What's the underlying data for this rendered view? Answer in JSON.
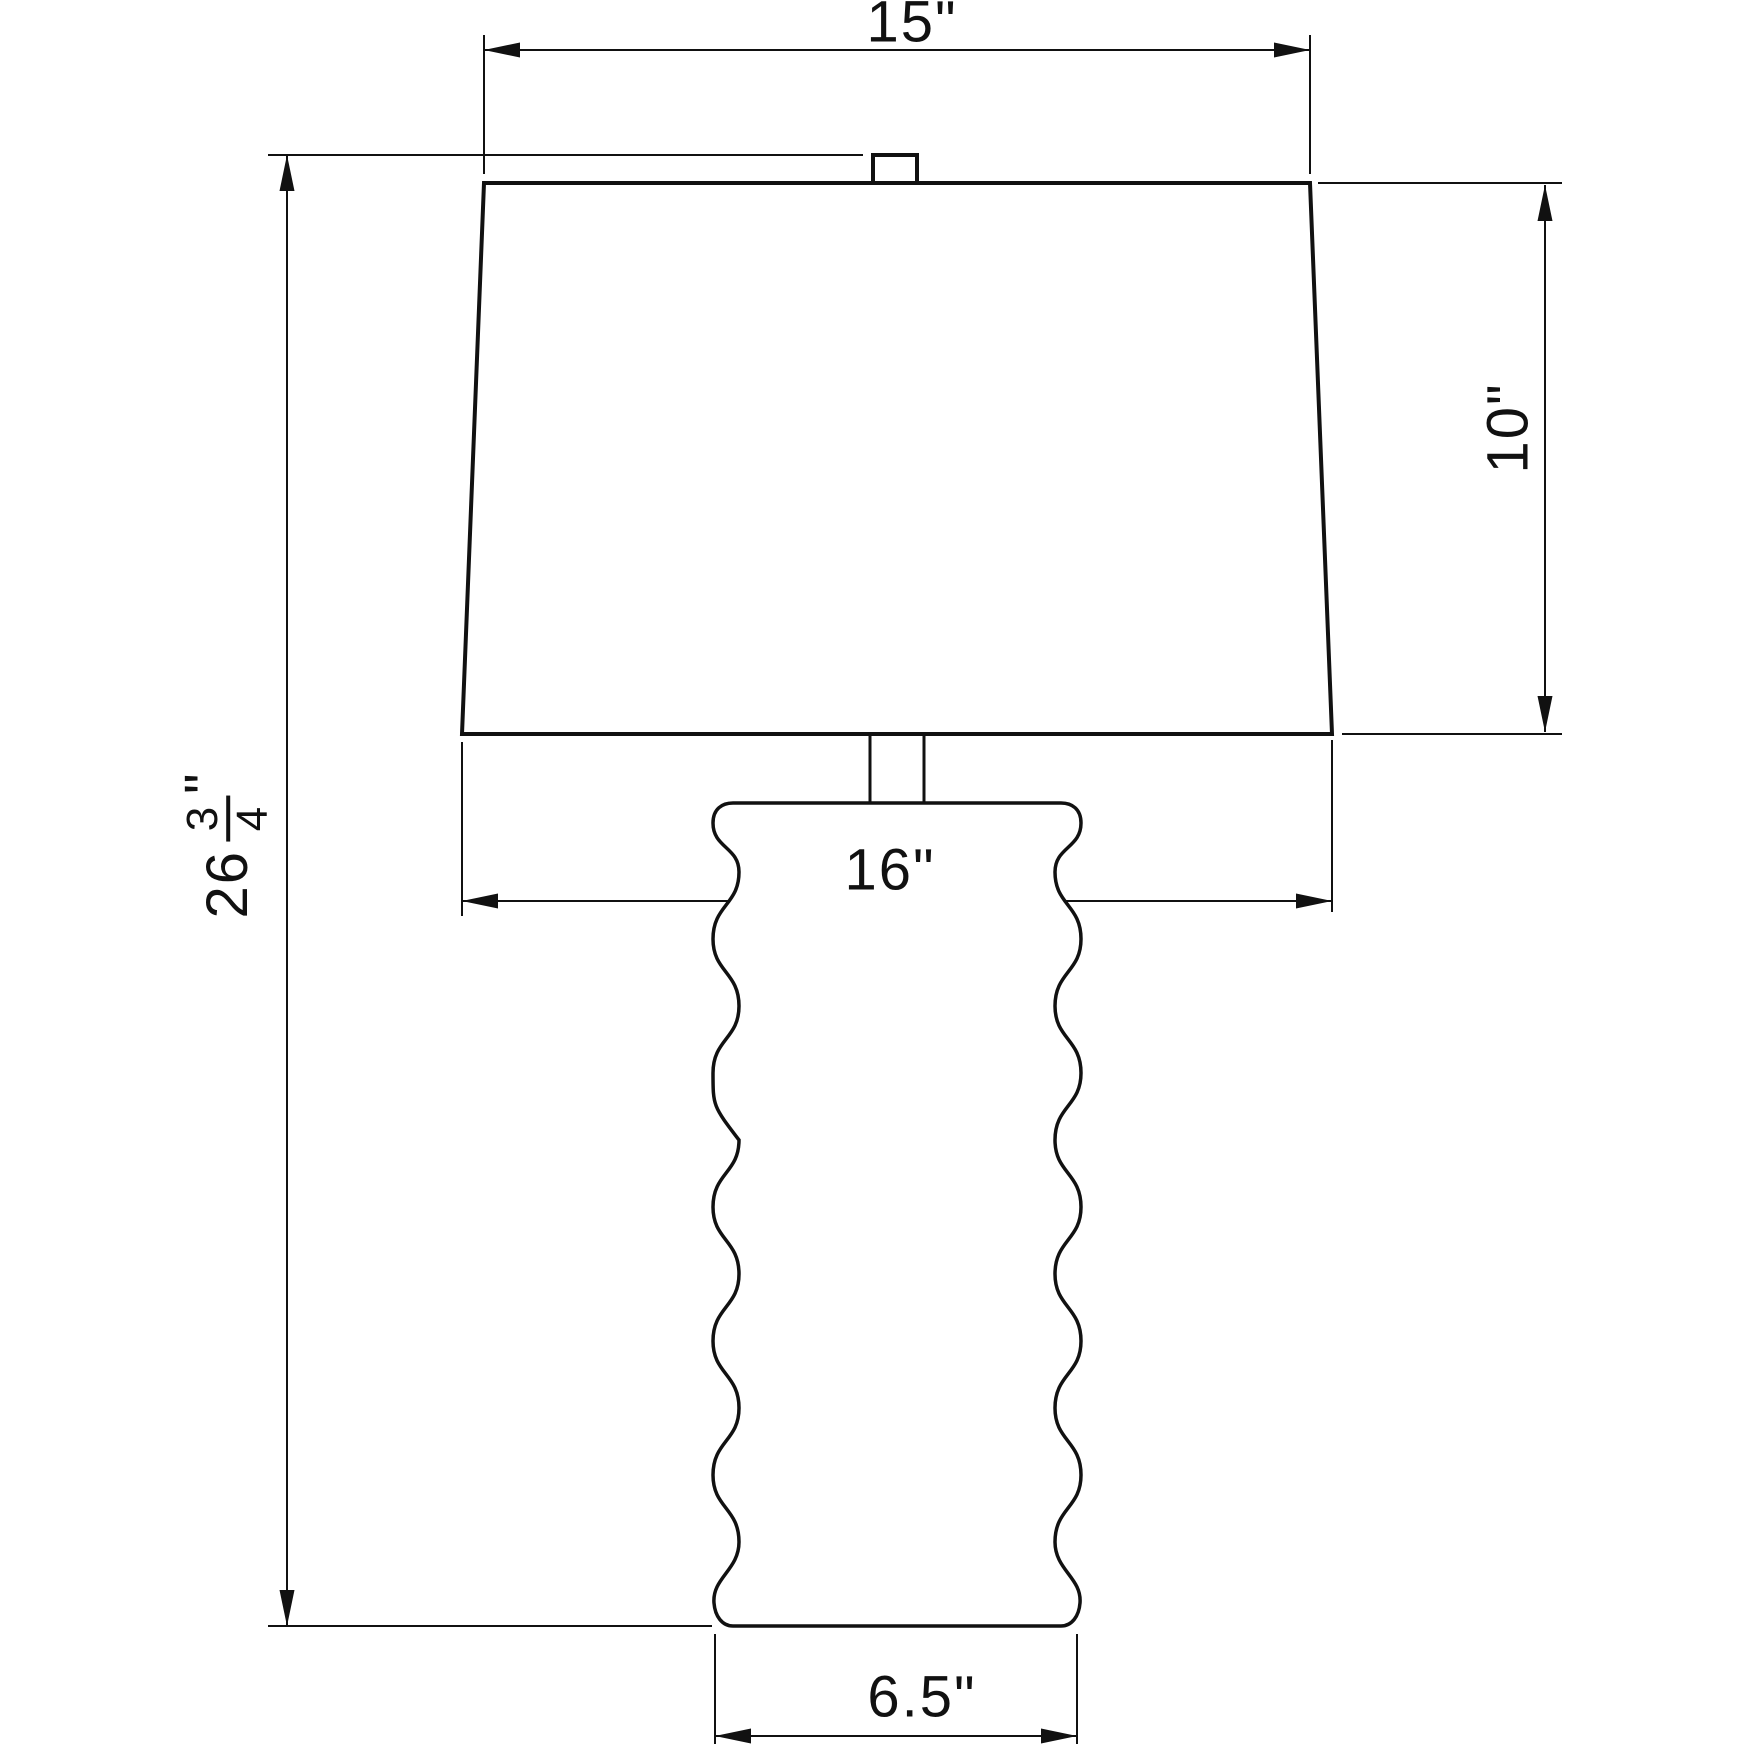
{
  "drawing": {
    "subject": "table-lamp-dimension-drawing",
    "colors": {
      "line": "#111111",
      "background": "#ffffff",
      "fill": "#ffffff"
    },
    "dimensions": {
      "shade_top_width": {
        "value": "15",
        "unit": "\""
      },
      "shade_height": {
        "value": "10",
        "unit": "\""
      },
      "total_height": {
        "whole": "26",
        "numerator": "3",
        "denominator": "4",
        "unit": "\""
      },
      "shade_bottom_width": {
        "value": "16",
        "unit": "\""
      },
      "base_width": {
        "value": "6.5",
        "unit": "\""
      }
    }
  }
}
